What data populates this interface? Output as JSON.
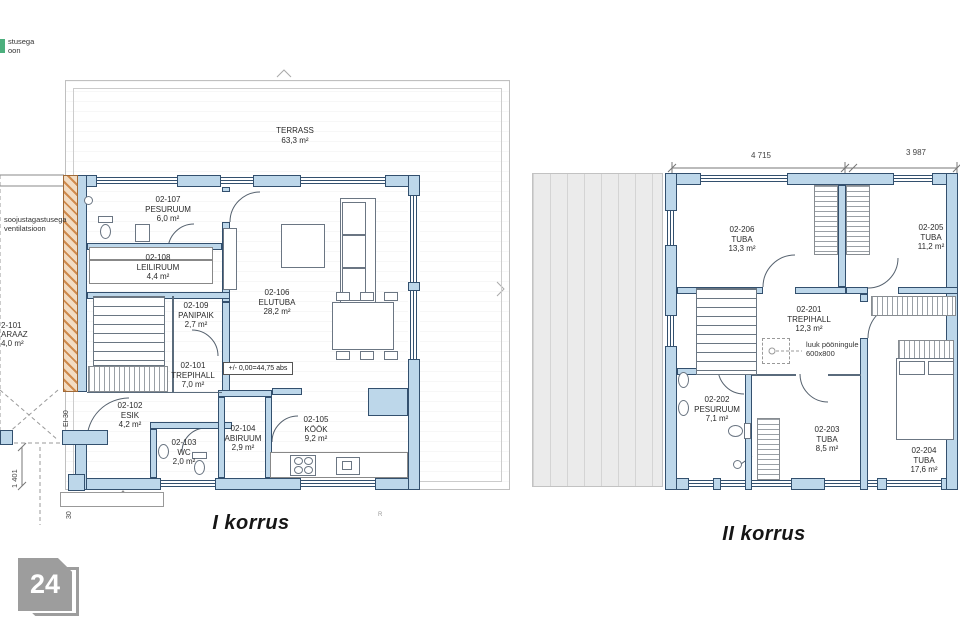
{
  "floor1": {
    "title": "I korrus",
    "terrace": {
      "name": "TERRASS",
      "area": "63,3 m²"
    },
    "rooms": [
      {
        "id": "02-107",
        "name": "PESURUUM",
        "area": "6,0 m²"
      },
      {
        "id": "02-108",
        "name": "LEILIRUUM",
        "area": "4,4 m²"
      },
      {
        "id": "02-109",
        "name": "PANIPAIK",
        "area": "2,7 m²"
      },
      {
        "id": "02-106",
        "name": "ELUTUBA",
        "area": "28,2 m²"
      },
      {
        "id": "02-101",
        "name": "TREPIHALL",
        "area": "7,0 m²"
      },
      {
        "id": "02-102",
        "name": "ESIK",
        "area": "4,2 m²"
      },
      {
        "id": "02-103",
        "name": "WC",
        "area": "2,0 m²"
      },
      {
        "id": "02-104",
        "name": "ABIRUUM",
        "area": "2,9 m²"
      },
      {
        "id": "02-105",
        "name": "KÖÖK",
        "area": "9,2 m²"
      }
    ],
    "garage_label_lines": [
      "2-101",
      "ARAAZ",
      "4,0 m²"
    ],
    "level_mark": "+/- 0,00=44,75 abs",
    "vent_note_lines": [
      "soojustagastusega",
      "ventilatsioon"
    ],
    "vent_note_top_lines": [
      "stusega",
      "oon"
    ],
    "fire_rating": "EI-30",
    "dim_entry_width": "1 401",
    "dim_small": "30",
    "corner_mark": "R"
  },
  "floor2": {
    "title": "II korrus",
    "dim_left": "4 715",
    "dim_right": "3 987",
    "rooms": [
      {
        "id": "02-206",
        "name": "TUBA",
        "area": "13,3 m²"
      },
      {
        "id": "02-205",
        "name": "TUBA",
        "area": "11,2 m²"
      },
      {
        "id": "02-201",
        "name": "TREPIHALL",
        "area": "12,3 m²"
      },
      {
        "id": "02-202",
        "name": "PESURUUM",
        "area": "7,1 m²"
      },
      {
        "id": "02-203",
        "name": "TUBA",
        "area": "8,5 m²"
      },
      {
        "id": "02-204",
        "name": "TUBA",
        "area": "17,6 m²"
      }
    ],
    "attic_note_lines": [
      "luuk pööningule",
      "600x800"
    ]
  },
  "badge": {
    "text": "24"
  },
  "colors": {
    "wall_fill": "#bdd7ea",
    "wall_outline": "#33506e",
    "firewall_hatch": "#d08a4c",
    "deck_fill": "#ebebeb",
    "badge_gray": "#9d9d9d"
  }
}
